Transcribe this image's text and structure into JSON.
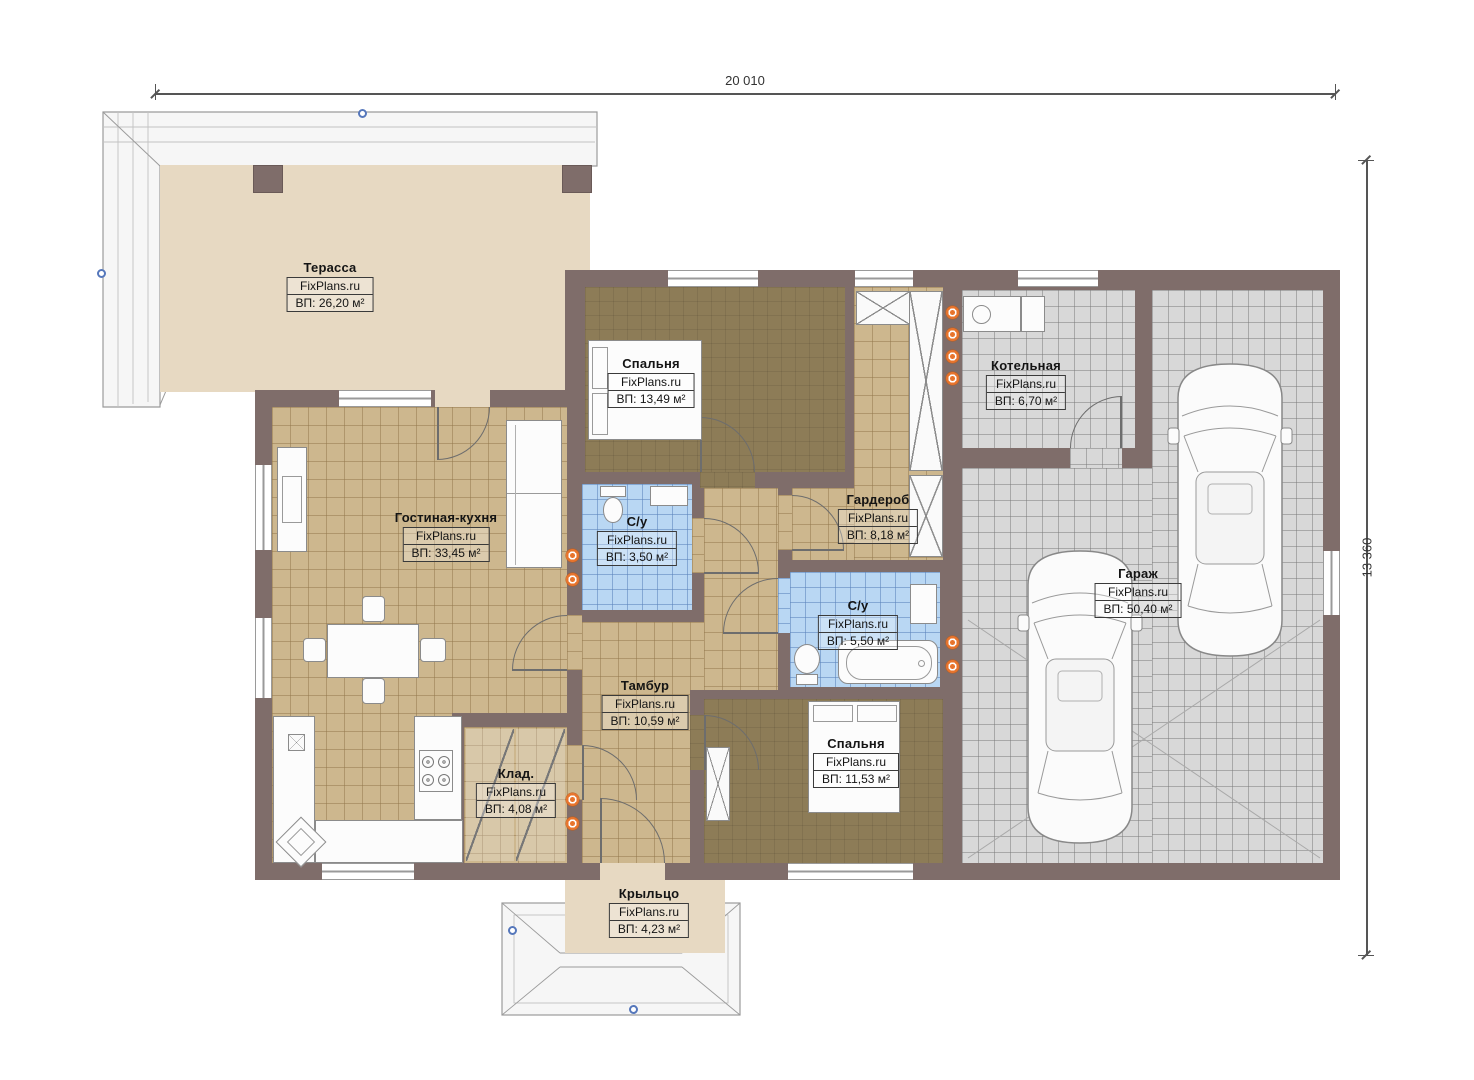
{
  "plan": {
    "brand": "FixPlans.ru",
    "dimensions": {
      "top": "20 010",
      "right": "13 360"
    },
    "rooms": {
      "terrace": {
        "title": "Терасса",
        "brand": "FixPlans.ru",
        "area": "ВП: 26,20 м²"
      },
      "bedroom_top": {
        "title": "Спальня",
        "brand": "FixPlans.ru",
        "area": "ВП: 13,49 м²"
      },
      "living_kitchen": {
        "title": "Гостиная-кухня",
        "brand": "FixPlans.ru",
        "area": "ВП: 33,45 м²"
      },
      "bathroom_small": {
        "title": "С/у",
        "brand": "FixPlans.ru",
        "area": "ВП: 3,50 м²"
      },
      "wardrobe": {
        "title": "Гардероб",
        "brand": "FixPlans.ru",
        "area": "ВП: 8,18 м²"
      },
      "boiler": {
        "title": "Котельная",
        "brand": "FixPlans.ru",
        "area": "ВП: 6,70 м²"
      },
      "garage": {
        "title": "Гараж",
        "brand": "FixPlans.ru",
        "area": "ВП: 50,40 м²"
      },
      "bathroom_big": {
        "title": "С/у",
        "brand": "FixPlans.ru",
        "area": "ВП: 5,50 м²"
      },
      "vestibule": {
        "title": "Тамбур",
        "brand": "FixPlans.ru",
        "area": "ВП: 10,59 м²"
      },
      "storage": {
        "title": "Клад.",
        "brand": "FixPlans.ru",
        "area": "ВП: 4,08 м²"
      },
      "bedroom_bottom": {
        "title": "Спальня",
        "brand": "FixPlans.ru",
        "area": "ВП: 11,53 м²"
      },
      "porch": {
        "title": "Крыльцо",
        "brand": "FixPlans.ru",
        "area": "ВП: 4,23 м²"
      }
    },
    "palette": {
      "wall": "#7f6d6a",
      "floor_tile_tan": "#cdb78e",
      "floor_dark": "#8d7c57",
      "bath_tile_blue": "#b9d7f3",
      "garage_tile_gray": "#d8d8d8",
      "terrace_beige": "#e7d9c2",
      "radiator_orange": "#e8742c",
      "roof_marker_blue": "#5577bb"
    }
  }
}
